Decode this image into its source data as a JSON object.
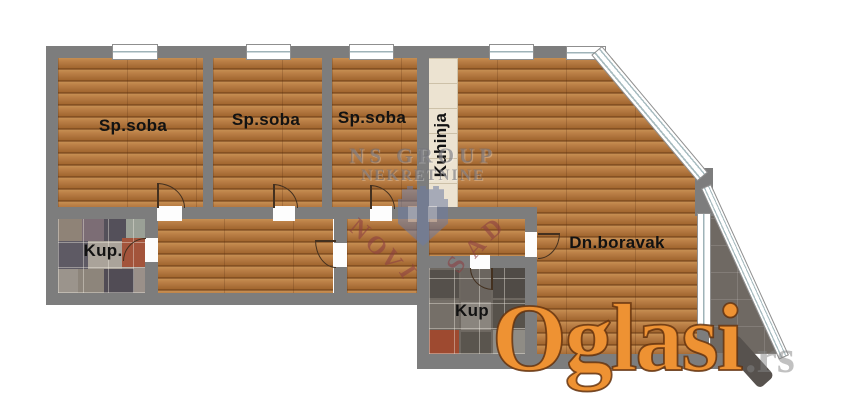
{
  "plan": {
    "rooms": [
      {
        "id": "bedroom-1",
        "label": "Sp.soba"
      },
      {
        "id": "bedroom-2",
        "label": "Sp.soba"
      },
      {
        "id": "bedroom-3",
        "label": "Sp.soba"
      },
      {
        "id": "kitchen",
        "label": "Kuhinja"
      },
      {
        "id": "bathroom-1",
        "label": "Kup."
      },
      {
        "id": "living-room",
        "label": "Dn.boravak"
      },
      {
        "id": "bathroom-2",
        "label": "Kup"
      }
    ]
  },
  "watermarks": {
    "agency_line1": "NS GROUP",
    "agency_line2": "NEKRETNINE",
    "agency_arc_text": "NOVI SAD",
    "novi_sad_letters": [
      {
        "ch": "N",
        "x": 350,
        "y": 216,
        "r": 40
      },
      {
        "ch": "O",
        "x": 366,
        "y": 232,
        "r": 47
      },
      {
        "ch": "V",
        "x": 382,
        "y": 246,
        "r": 53
      },
      {
        "ch": "I",
        "x": 402,
        "y": 258,
        "r": 58
      },
      {
        "ch": "S",
        "x": 450,
        "y": 251,
        "r": -56
      },
      {
        "ch": "A",
        "x": 467,
        "y": 234,
        "r": -47
      },
      {
        "ch": "D",
        "x": 484,
        "y": 216,
        "r": -40
      }
    ],
    "site_name": "Oglasi",
    "site_tld": ".rs"
  },
  "colors": {
    "wall": "#7d7d7d",
    "wood_floor": "#b27a42",
    "kitchen_tile": "#ece3d1",
    "terrace_tile": "#6f6963",
    "site_watermark_orange": "#ee9233",
    "agency_watermark_gray": "#707078",
    "agency_watermark_red": "#8c3e42",
    "emblem_blue": "#6d7ca3"
  }
}
